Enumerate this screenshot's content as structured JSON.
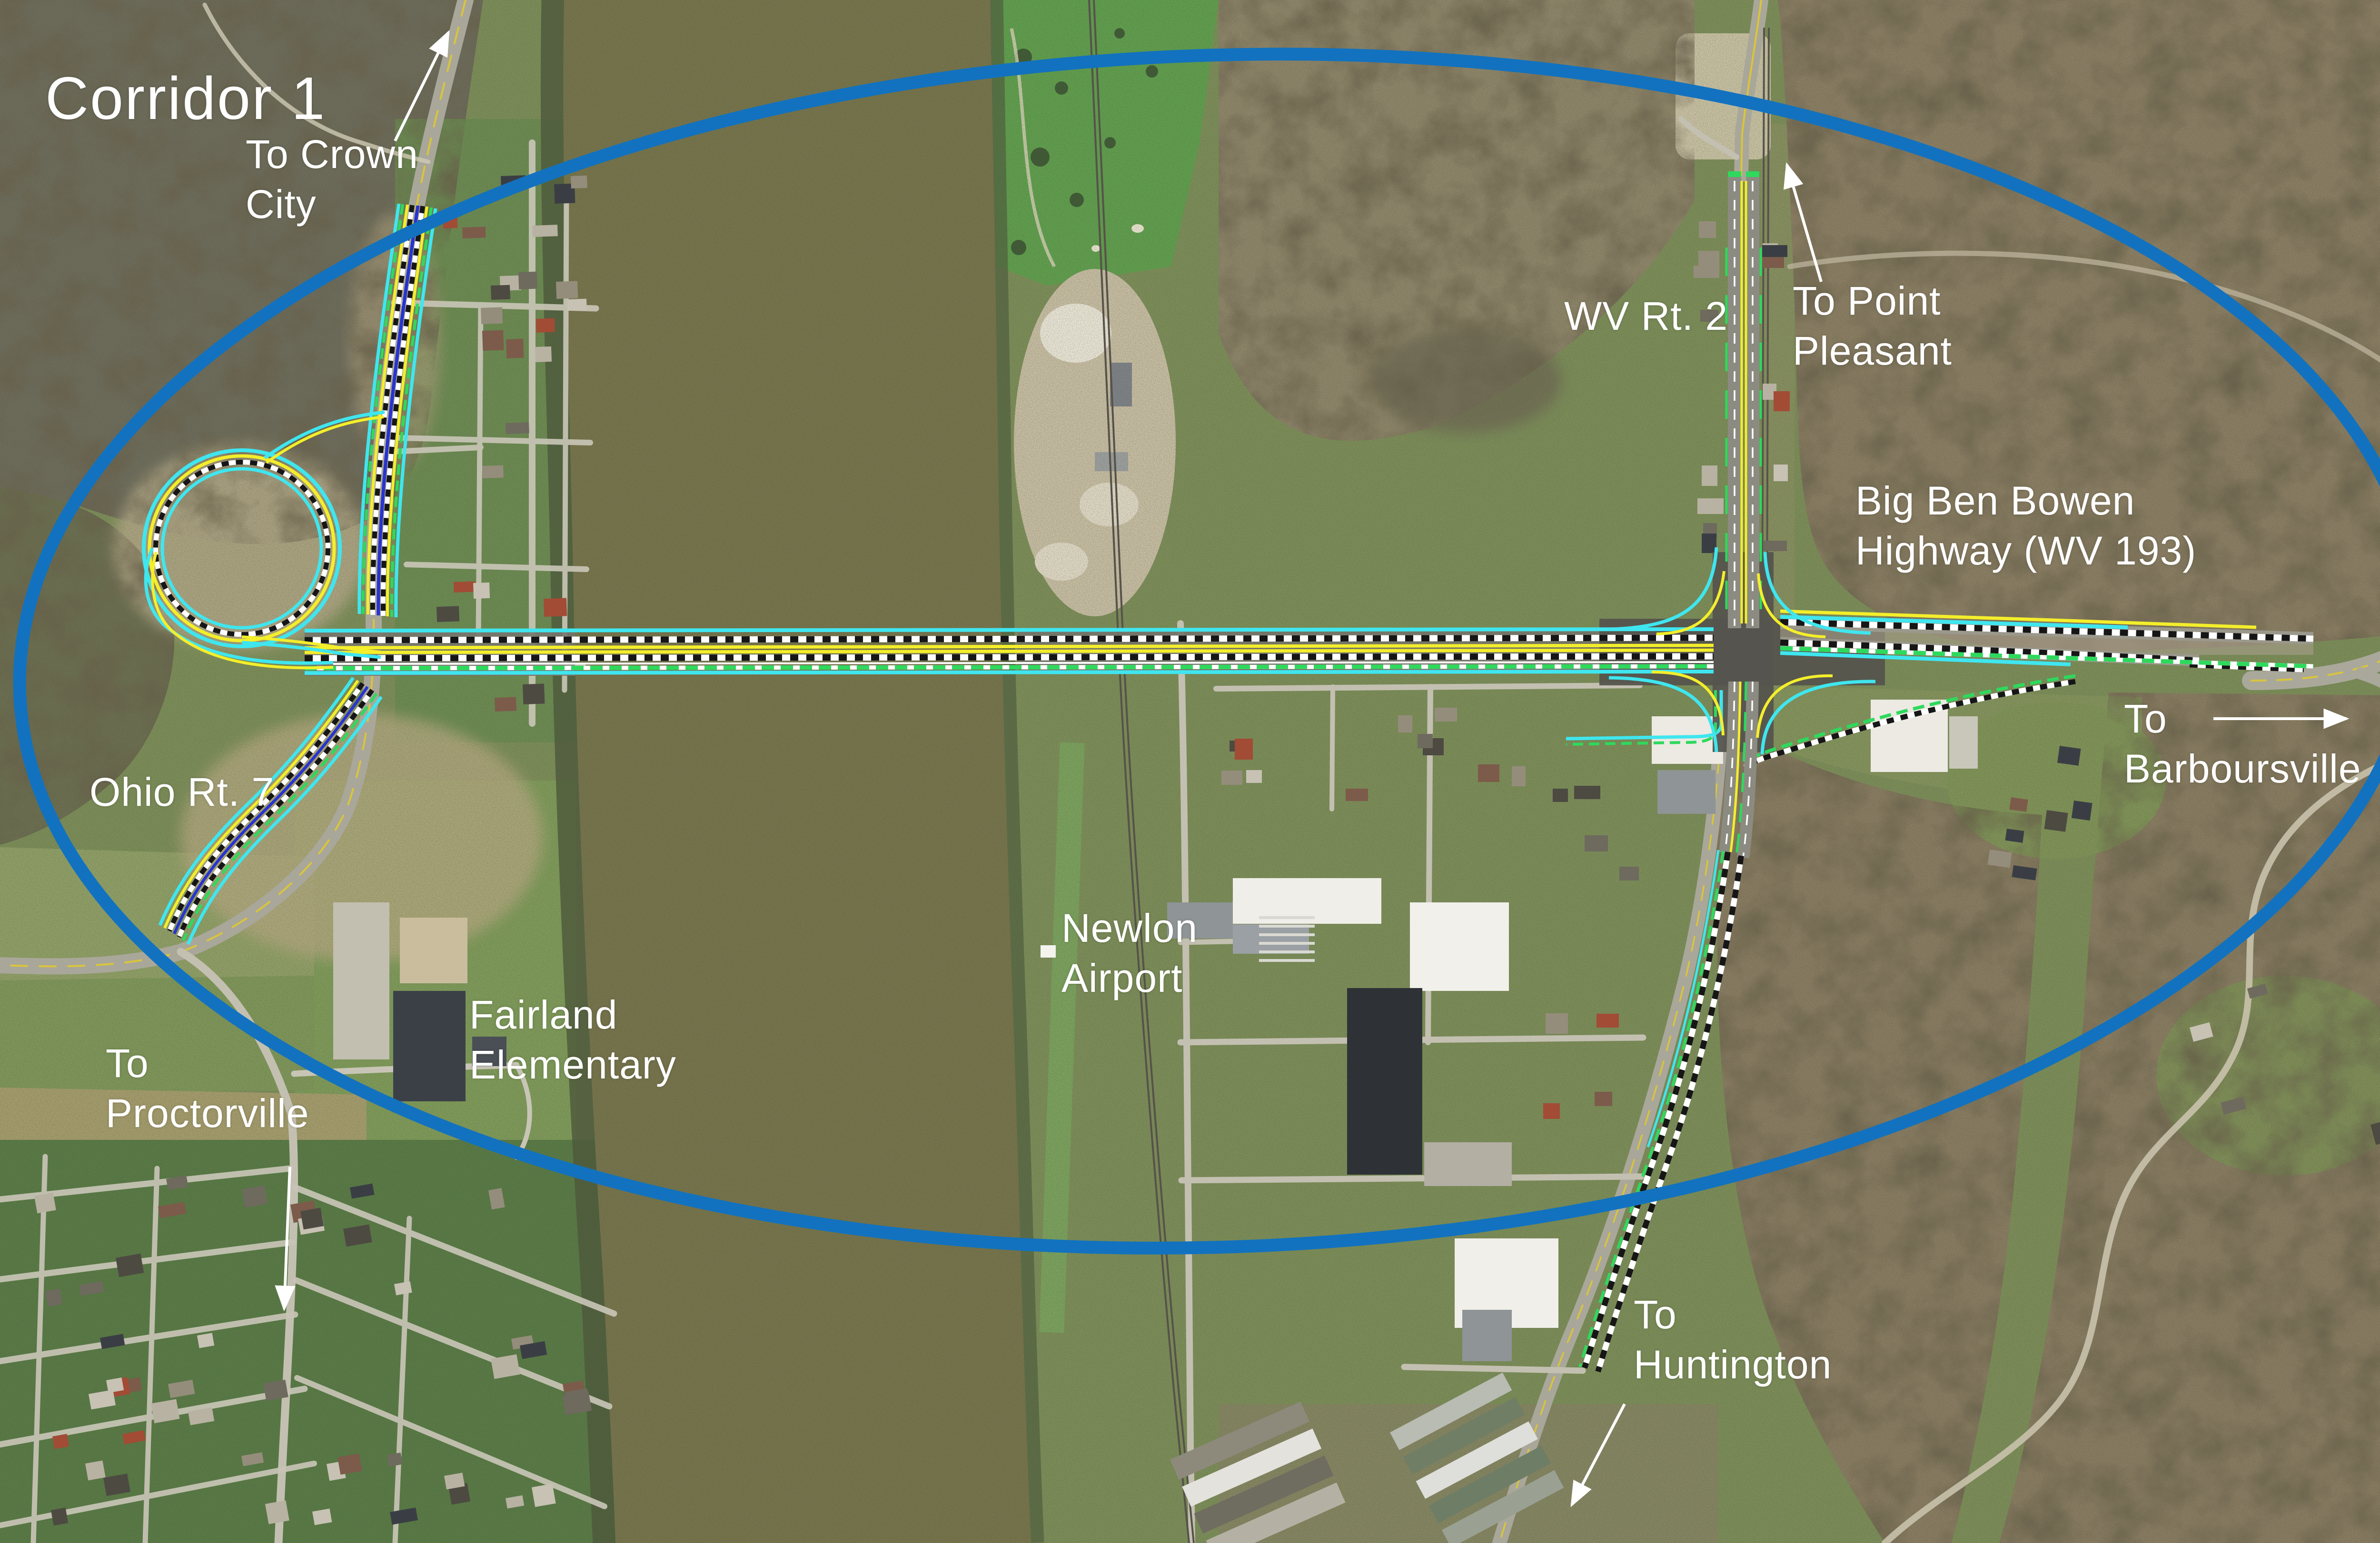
{
  "page": {
    "heading": "Corridor 1"
  },
  "map": {
    "labels": {
      "corridor": "Corridor 1",
      "to_crown_city": "To Crown\nCity",
      "wv_rt_2": "WV Rt. 2",
      "to_point_pleasant": "To Point\nPleasant",
      "big_ben_bowen": "Big Ben Bowen\nHighway (WV 193)",
      "to_barboursville": "To\nBarboursville",
      "ohio_rt_7": "Ohio Rt. 7",
      "newlon_airport": "Newlon\nAirport",
      "fairland_elementary": "Fairland\nElementary",
      "to_proctorville": "To\nProctorville",
      "to_huntington": "To\nHuntington"
    },
    "arrows": [
      {
        "name": "to-crown-city-arrow",
        "direction": "up"
      },
      {
        "name": "to-point-pleasant-arrow",
        "direction": "up"
      },
      {
        "name": "to-barboursville-arrow",
        "direction": "right"
      },
      {
        "name": "to-proctorville-arrow",
        "direction": "down"
      },
      {
        "name": "to-huntington-arrow",
        "direction": "down-left"
      }
    ],
    "colors": {
      "study_ellipse": "#1272bf",
      "alignment_cyan": "#3fe6ef",
      "alignment_green": "#2ed95d",
      "alignment_yellow": "#f4ee2b",
      "alignment_blue": "#2733d0",
      "river": "#76744b",
      "label_text": "#ffffff"
    }
  }
}
